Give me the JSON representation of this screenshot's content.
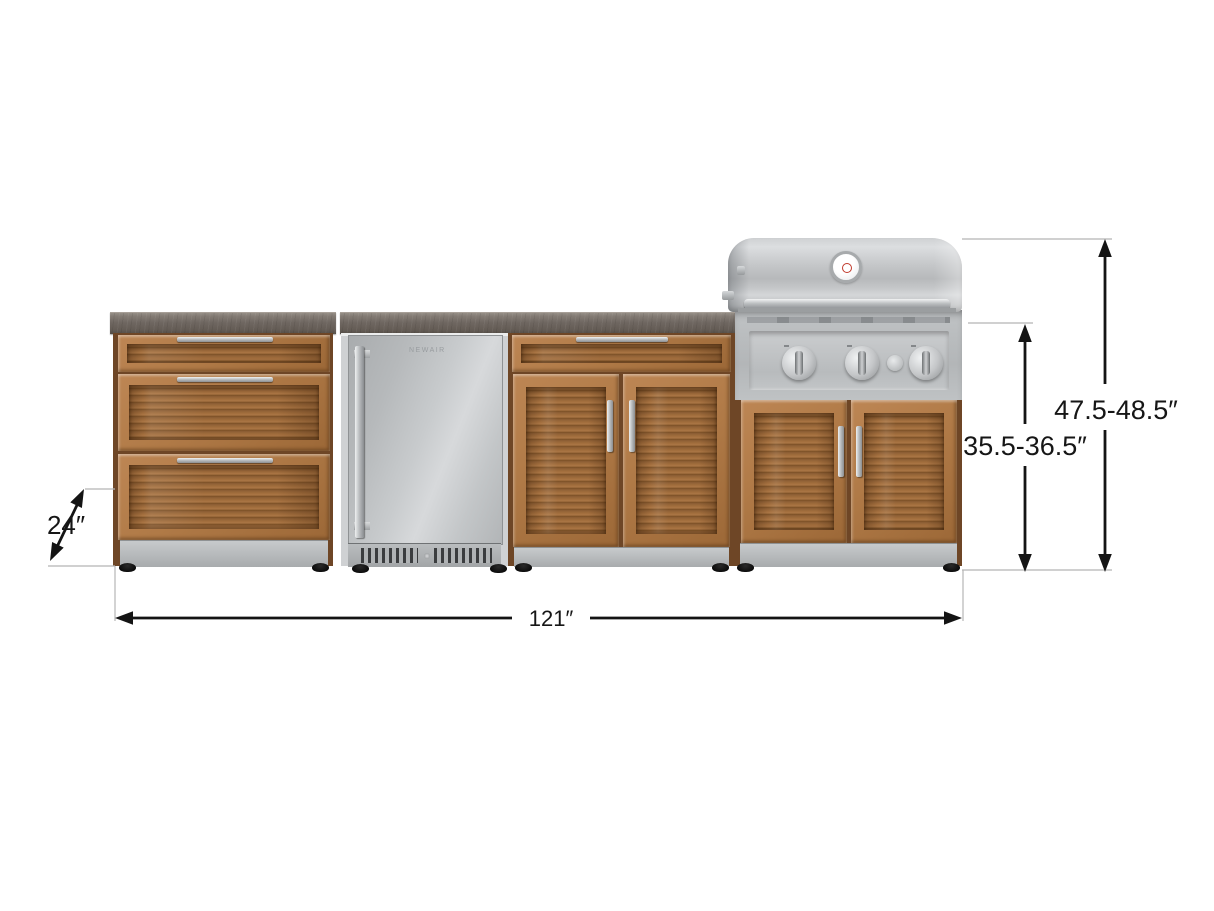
{
  "scene": {
    "description": "Outdoor kitchen cabinet set with 3-drawer cabinet, fridge, bar cabinet and grill, shown with dimension lines",
    "background": "#ffffff"
  },
  "dimensions": {
    "depth": "24″",
    "width": "121″",
    "counter_height": "35.5-36.5″",
    "overall_height": "47.5-48.5″"
  },
  "fridge": {
    "brand": "NEWAIR"
  },
  "colors": {
    "wood_frame": "#b07a47",
    "wood_slat_dark": "#7b5026",
    "stainless": "#c3c5c7",
    "countertop": "#6f6761",
    "dimension_line": "#141414",
    "extension_line": "#b5b5b5",
    "feet": "#000000"
  }
}
